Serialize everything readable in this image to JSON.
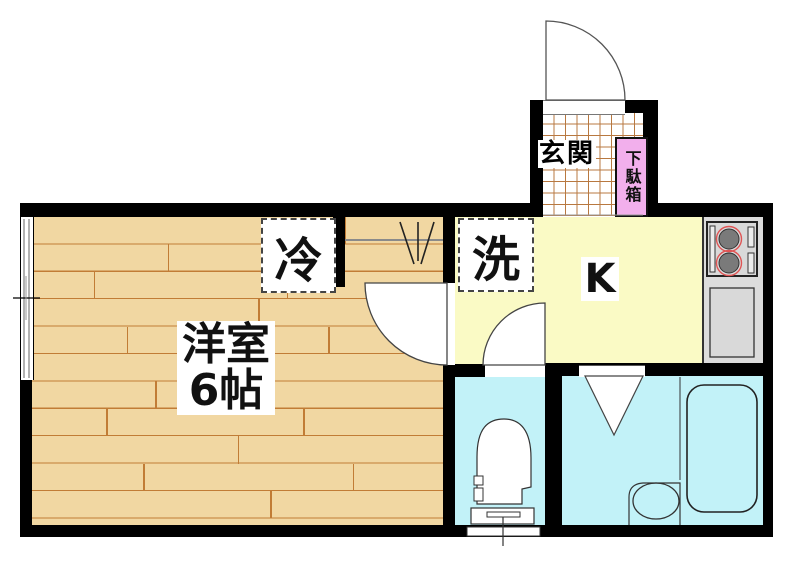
{
  "plan": {
    "type": "apartment floor plan",
    "rooms": {
      "main_room": {
        "label_line1": "洋室",
        "label_line2": "6帖"
      },
      "kitchen": {
        "label": "K"
      },
      "entrance": {
        "label": "玄関"
      },
      "shoe_cabinet": {
        "label": "下駄箱"
      },
      "refrigerator_space": {
        "label": "冷"
      },
      "washer_space": {
        "label": "洗"
      }
    },
    "colors": {
      "wall": "#000000",
      "wood_floor": "#F1D7A2",
      "wood_plank_line": "#C17C36",
      "kitchen_floor": "#FAFAC5",
      "wet_room_floor": "#C2F2F8",
      "shoe_cabinet_fill": "#F2AFEC",
      "entrance_tile_line": "#B87840",
      "counter": "#DCDCDC",
      "stove_burner": "#7A7A7A",
      "stove_burner_ring": "#E05555"
    }
  }
}
